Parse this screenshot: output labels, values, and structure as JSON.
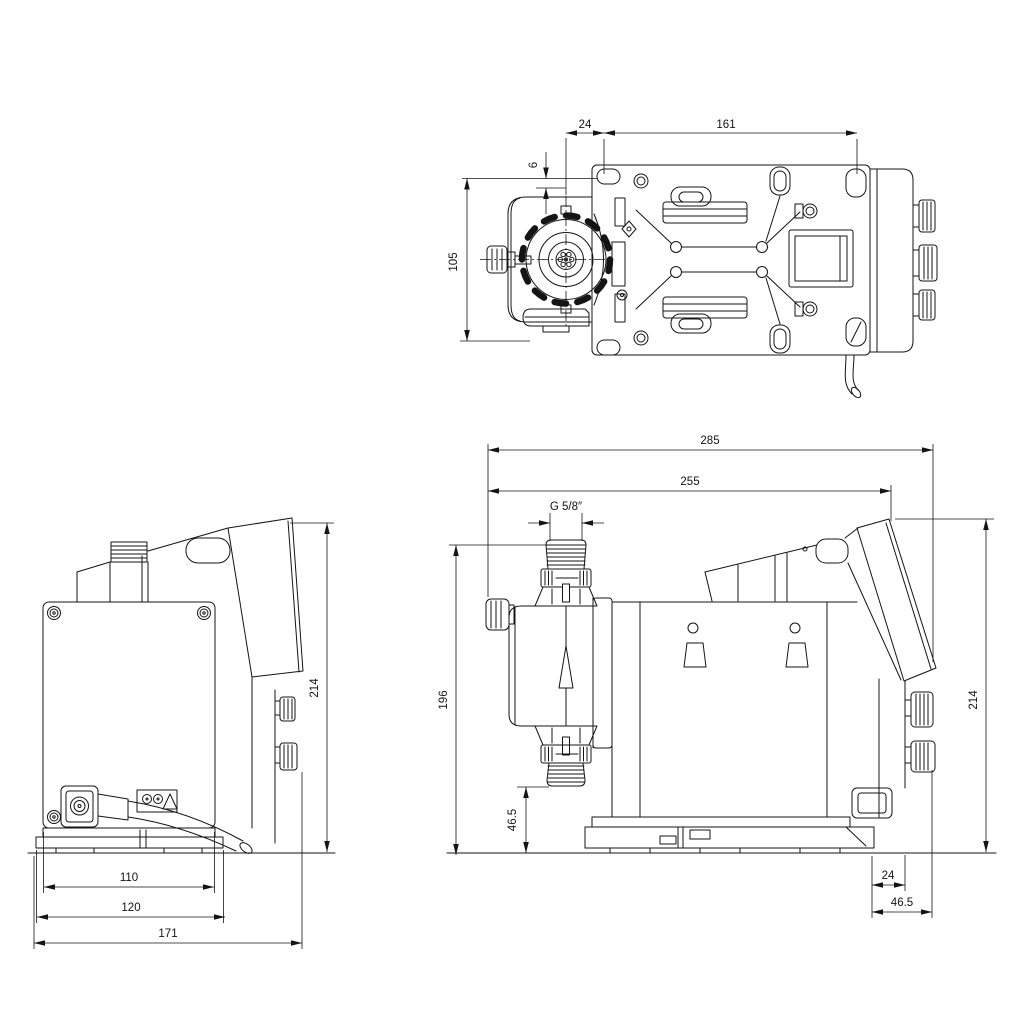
{
  "canvas": {
    "width": 1024,
    "height": 1024,
    "background": "#ffffff",
    "line_color": "#141414"
  },
  "drawing": {
    "kind": "technical-dimension-drawing",
    "subject": "diaphragm dosing pump — three orthographic views",
    "views": [
      {
        "id": "top-view",
        "position": "upper-right"
      },
      {
        "id": "front-view",
        "position": "lower-left"
      },
      {
        "id": "side-view",
        "position": "lower-right"
      }
    ]
  },
  "dims": {
    "top": {
      "offset_24": "24",
      "hole_spacing_161": "161",
      "edge_6": "6",
      "depth_105": "105"
    },
    "front": {
      "height_214": "214",
      "plate_110": "110",
      "base_120": "120",
      "width_171": "171"
    },
    "side": {
      "overall_285": "285",
      "length_255": "255",
      "thread": "G 5/8″",
      "height_196": "196",
      "suction_46_5": "46.5",
      "height_214": "214",
      "rear_24": "24",
      "rear_46_5": "46.5"
    }
  }
}
